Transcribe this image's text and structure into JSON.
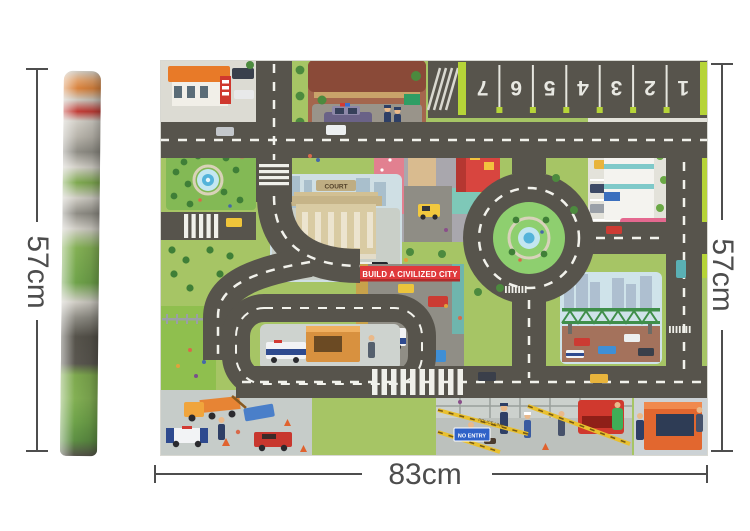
{
  "annotations": {
    "left_height": "57cm",
    "right_height": "57cm",
    "bottom_width": "83cm"
  },
  "mat": {
    "banner_text": "BUILD A CIVILIZED CITY",
    "parking_numbers": [
      "1",
      "2",
      "3",
      "4",
      "5",
      "6",
      "7"
    ],
    "court_sign": "COURT",
    "no_entry_sign": "NO ENTRY",
    "police_line_tape": "POLICE LINE",
    "police_van_label": "POLICE",
    "colors": {
      "grass": "#a6c565",
      "road": "#57544c",
      "banner_red": "#e0393c",
      "lime": "#b6d438",
      "tape_yellow": "#e9c02f",
      "dimension_line": "#4e4e4e"
    }
  }
}
